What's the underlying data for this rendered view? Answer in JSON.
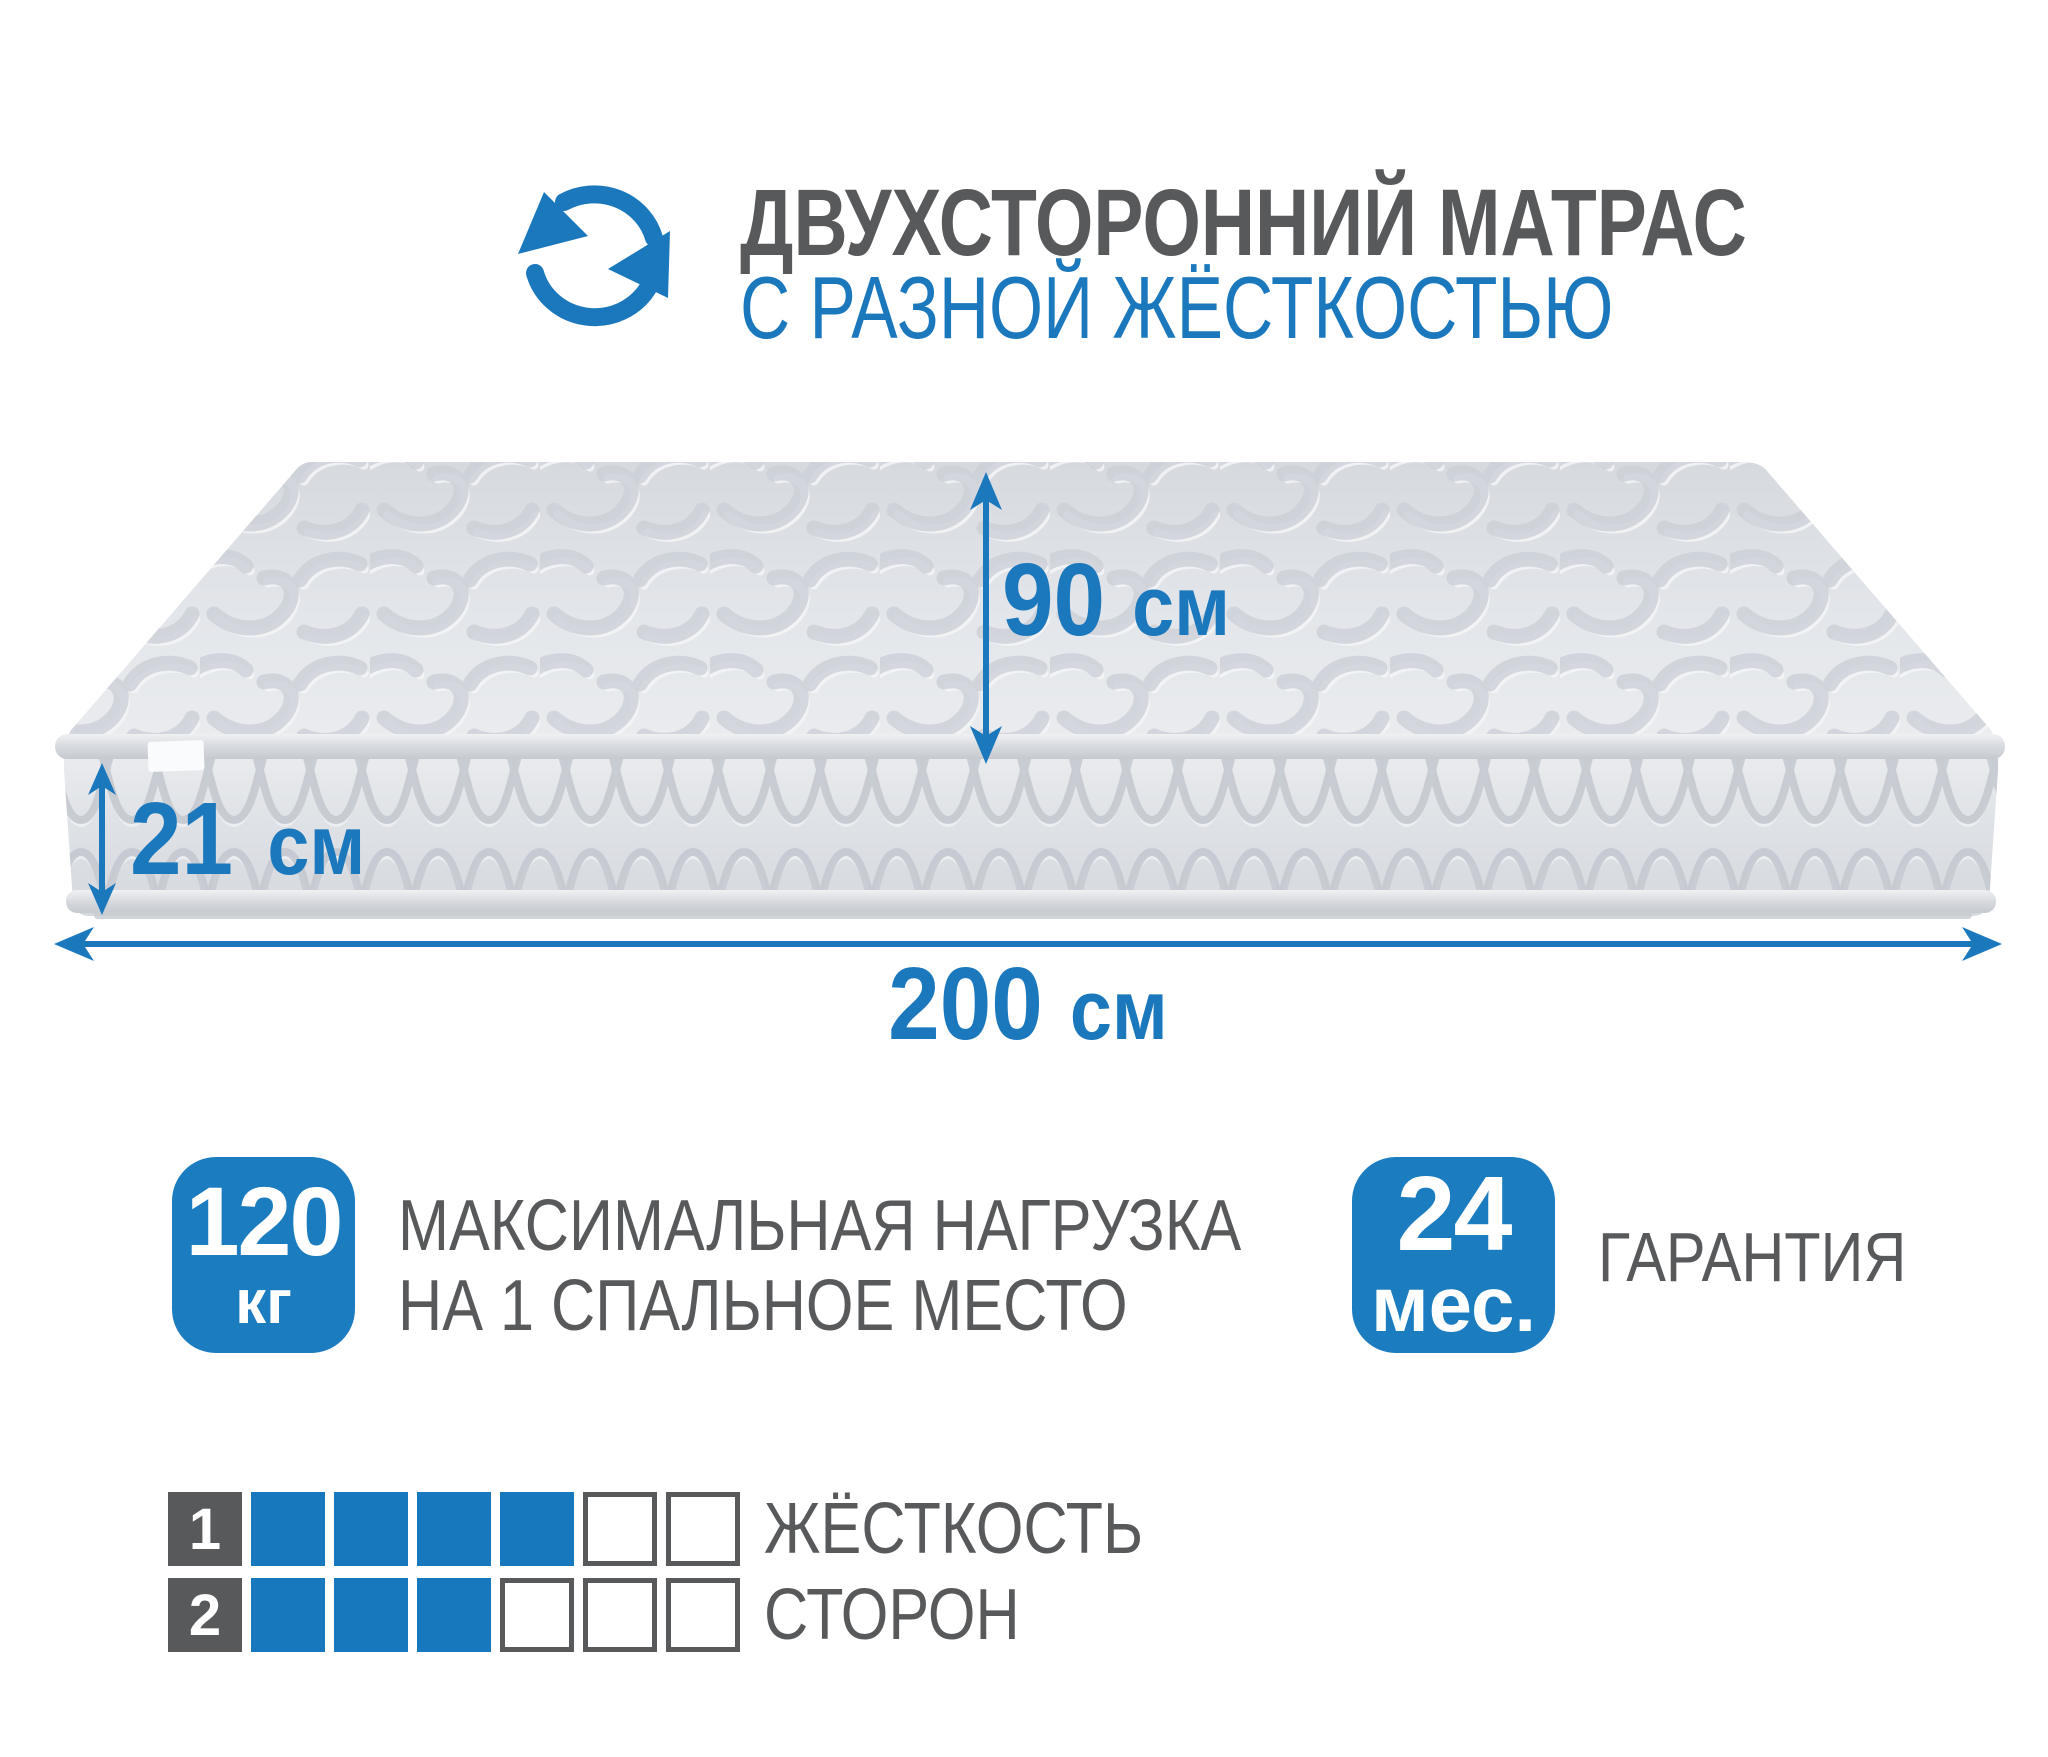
{
  "header": {
    "title": "ДВУХСТОРОННИЙ МАТРАС",
    "subtitle": "С РАЗНОЙ ЖЁСТКОСТЬЮ",
    "icon": "rotate-cycle-icon"
  },
  "dimensions": {
    "width_top": {
      "value": "90",
      "unit": "см"
    },
    "height_side": {
      "value": "21",
      "unit": "см"
    },
    "length_bottom": {
      "value": "200",
      "unit": "см"
    }
  },
  "max_load": {
    "value": "120",
    "unit": "кг",
    "label_line1": "МАКСИМАЛЬНАЯ НАГРУЗКА",
    "label_line2": "НА 1 СПАЛЬНОЕ МЕСТО"
  },
  "warranty": {
    "value": "24",
    "unit": "мес.",
    "label": "ГАРАНТИЯ"
  },
  "firmness": {
    "label_line1": "ЖЁСТКОСТЬ",
    "label_line2": "СТОРОН",
    "scale_max": 6,
    "sides": [
      {
        "label": "1",
        "level": 4
      },
      {
        "label": "2",
        "level": 3
      }
    ]
  },
  "colors": {
    "accent_blue": "#1c78bd",
    "badge_blue": "#1c7cc0",
    "text_gray": "#58595b",
    "grid_dark": "#58595a",
    "mattress_light": "#e3e6ea",
    "quilt_line": "#c6cad1"
  }
}
